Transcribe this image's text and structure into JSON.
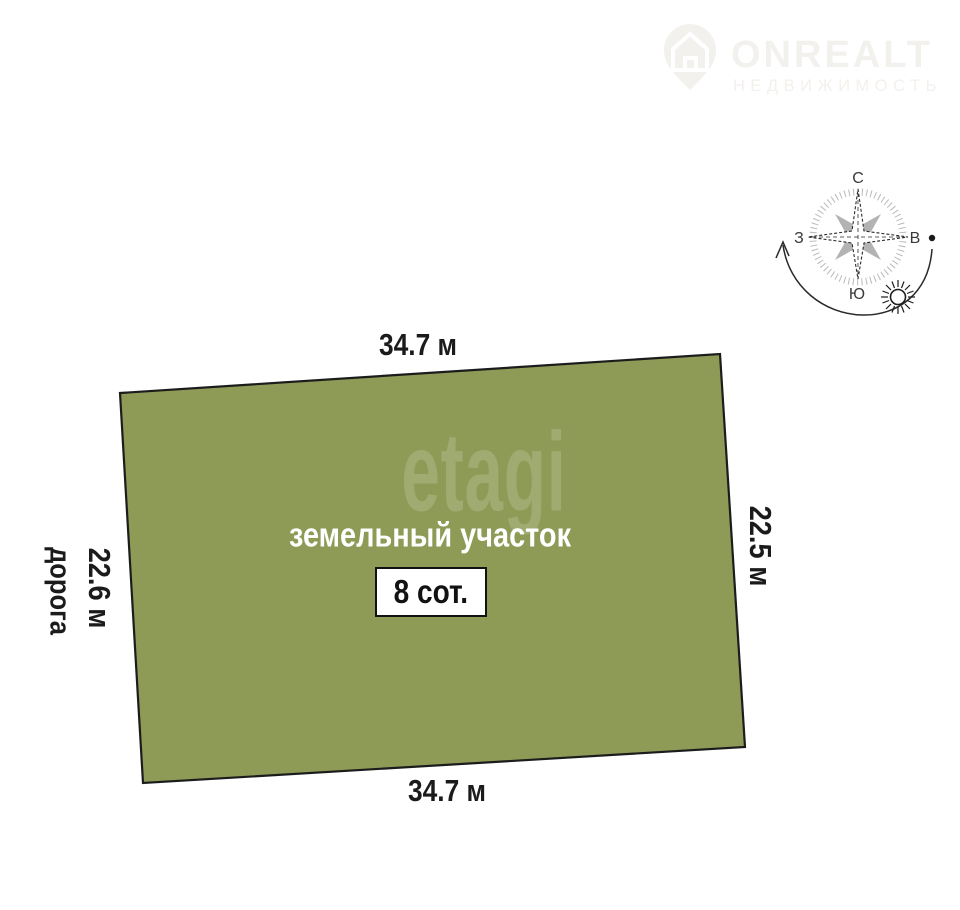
{
  "header": {
    "brand": "ONREALT",
    "brand_sub": "НЕДВИЖИМОСТЬ"
  },
  "watermark": "etagi",
  "plot": {
    "title": "земельный участок",
    "area": "8 сот.",
    "fill": "#8d9b56",
    "stroke": "#1c1c1c",
    "dim_top": "34.7 м",
    "dim_bottom": "34.7 м",
    "dim_left": "22.6 м",
    "dim_right": "22.5 м",
    "road": "дорога"
  },
  "compass": {
    "north": "С",
    "south": "Ю",
    "west": "З",
    "east": "В"
  }
}
